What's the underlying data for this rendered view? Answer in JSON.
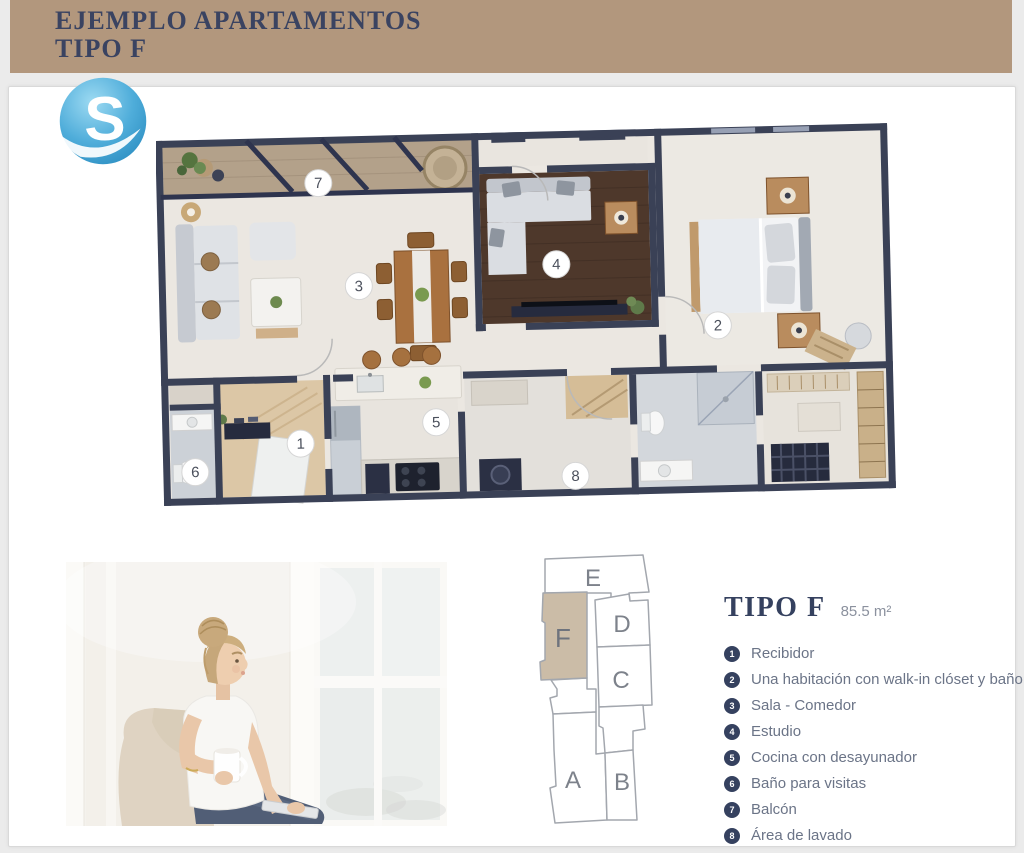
{
  "header": {
    "title_line1": "EJEMPLO APARTAMENTOS",
    "title_line2": "TIPO F"
  },
  "logo": {
    "letter": "S"
  },
  "floor_plan": {
    "markers": [
      {
        "num": "1",
        "x": 142,
        "y": 318
      },
      {
        "num": "2",
        "x": 562,
        "y": 210
      },
      {
        "num": "3",
        "x": 204,
        "y": 162
      },
      {
        "num": "4",
        "x": 402,
        "y": 145
      },
      {
        "num": "5",
        "x": 278,
        "y": 300
      },
      {
        "num": "6",
        "x": 36,
        "y": 344
      },
      {
        "num": "7",
        "x": 166,
        "y": 58
      },
      {
        "num": "8",
        "x": 416,
        "y": 357
      }
    ]
  },
  "unit_key": {
    "highlighted": "F",
    "units": [
      {
        "letter": "E"
      },
      {
        "letter": "F"
      },
      {
        "letter": "D"
      },
      {
        "letter": "C"
      },
      {
        "letter": "A"
      },
      {
        "letter": "B"
      }
    ]
  },
  "info": {
    "title": "TIPO F",
    "area": "85.5 m²",
    "legend": [
      {
        "num": "1",
        "label": "Recibidor"
      },
      {
        "num": "2",
        "label": "Una habitación con walk-in clóset y baño"
      },
      {
        "num": "3",
        "label": "Sala - Comedor"
      },
      {
        "num": "4",
        "label": "Estudio"
      },
      {
        "num": "5",
        "label": "Cocina con desayunador"
      },
      {
        "num": "6",
        "label": "Baño para visitas"
      },
      {
        "num": "7",
        "label": "Balcón"
      },
      {
        "num": "8",
        "label": "Área de lavado"
      }
    ]
  },
  "colors": {
    "header_bg": "#b2977d",
    "accent_navy": "#35415f",
    "wall_navy": "#3a4156",
    "unit_highlight": "#cbbca7",
    "logo_blue": "#47a9d6",
    "legend_text": "#6b7487"
  }
}
